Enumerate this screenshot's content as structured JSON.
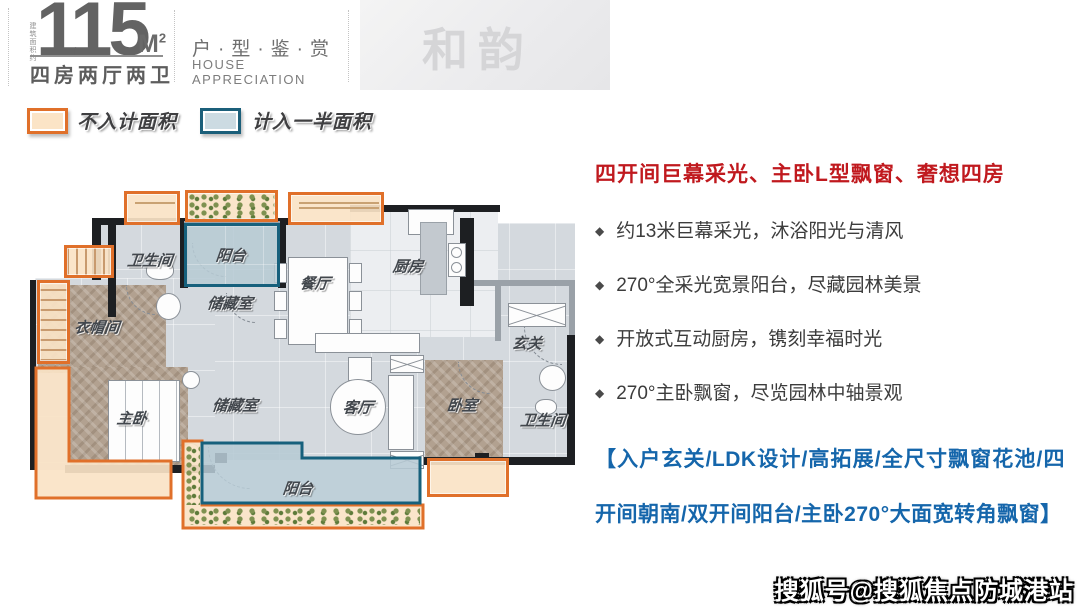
{
  "header": {
    "area_prefix": "建筑面积约",
    "area_number": "115",
    "area_unit_letter": "M",
    "area_unit_sup": "2",
    "layout": "四房两厅两卫",
    "series_cn": "户·型·鉴·赏",
    "series_en": "HOUSE APPRECIATION",
    "project_watermark": "和韵"
  },
  "legend": {
    "items": [
      {
        "label": "不入计面积",
        "type": "orange"
      },
      {
        "label": "计入一半面积",
        "type": "blue"
      }
    ]
  },
  "floorplan": {
    "labels": {
      "bath1": "卫生间",
      "balcony_top": "阳台",
      "storage1": "储藏室",
      "cloakroom": "衣帽间",
      "master_bedroom": "主卧",
      "storage2": "储藏室",
      "dining": "餐厅",
      "kitchen": "厨房",
      "foyer": "玄关",
      "living": "客厅",
      "bedroom": "卧室",
      "bath2": "卫生间",
      "balcony_bottom": "阳台"
    }
  },
  "highlights": {
    "title": "四开间巨幕采光、主卧L型飘窗、奢想四房",
    "bullets": [
      "约13米巨幕采光，沐浴阳光与清风",
      "270°全采光宽景阳台，尽藏园林美景",
      "开放式互动厨房，镌刻幸福时光",
      "270°主卧飘窗，尽览园林中轴景观"
    ],
    "footer": "【入户玄关/LDK设计/高拓展/全尺寸飘窗花池/四开间朝南/双开间阳台/主卧270°大面宽转角飘窗】"
  },
  "bottom_watermark": "搜狐号@搜狐焦点防城港站",
  "colors": {
    "accent_orange": "#e0702a",
    "accent_blue": "#16607c",
    "headline_red": "#c0191e",
    "feature_blue": "#1566ab"
  }
}
